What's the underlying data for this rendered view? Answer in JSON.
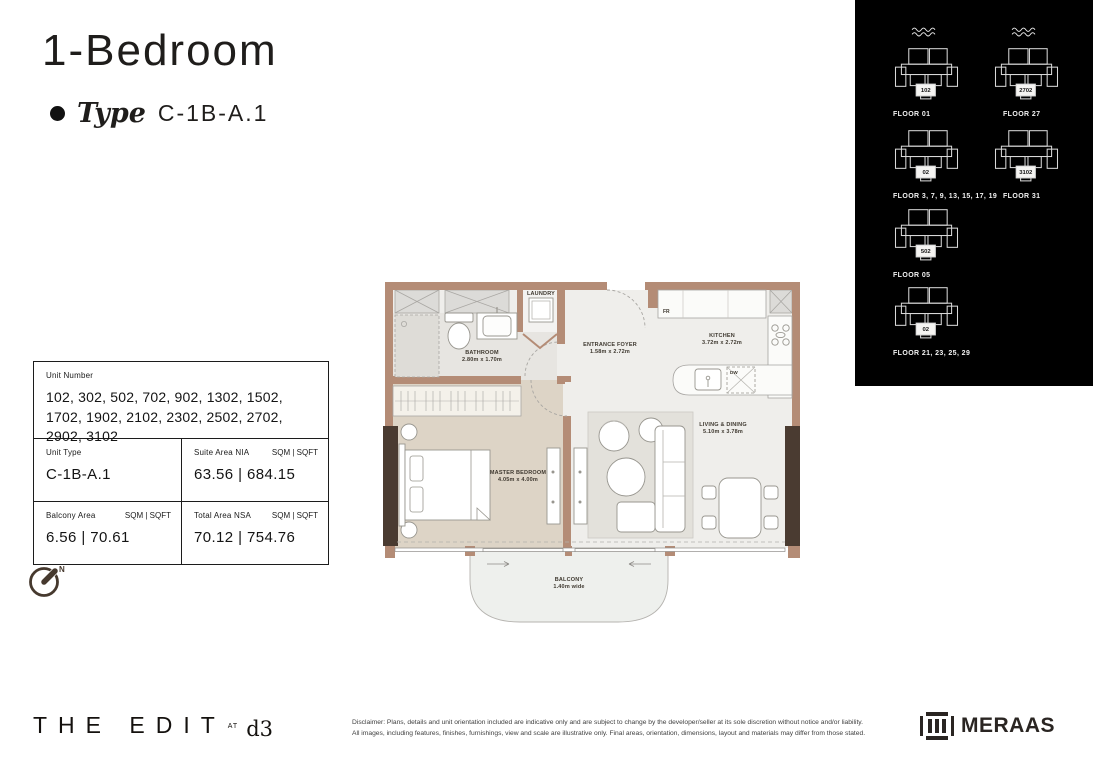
{
  "header": {
    "title": "1-Bedroom",
    "type_label": "Type",
    "type_value": "C-1B-A.1"
  },
  "unit_table": {
    "unit_number_label": "Unit Number",
    "unit_numbers": "102, 302, 502, 702, 902, 1302, 1502, 1702, 1902, 2102, 2302, 2502, 2702, 2902, 3102",
    "unit_type_label": "Unit Type",
    "unit_type_value": "C-1B-A.1",
    "suite_area_label": "Suite Area NIA",
    "suite_area_units": "SQM  |  SQFT",
    "suite_area_value": "63.56  |  684.15",
    "balcony_area_label": "Balcony Area",
    "balcony_area_units": "SQM  |  SQFT",
    "balcony_area_value": "6.56  |  70.61",
    "total_area_label": "Total Area NSA",
    "total_area_units": "SQM  |  SQFT",
    "total_area_value": "70.12  |  754.76"
  },
  "compass": {
    "north_label": "N"
  },
  "floor_plan": {
    "rooms": {
      "laundry": {
        "name": "LAUNDRY",
        "dims": ""
      },
      "bathroom": {
        "name": "BATHROOM",
        "dims": "2.80m x 1.70m"
      },
      "foyer": {
        "name": "ENTRANCE FOYER",
        "dims": "1.58m x 2.72m"
      },
      "kitchen": {
        "name": "KITCHEN",
        "dims": "3.72m x 2.72m"
      },
      "bedroom": {
        "name": "MASTER BEDROOM",
        "dims": "4.05m x 4.00m"
      },
      "living": {
        "name": "LIVING & DINING",
        "dims": "5.10m x 3.78m"
      },
      "balcony": {
        "name": "BALCONY",
        "dims": "1.40m wide"
      }
    },
    "labels": {
      "fridge": "FR",
      "dishwasher": "DW"
    }
  },
  "floor_plates": [
    {
      "floor_label": "FLOOR  01",
      "unit": "102"
    },
    {
      "floor_label": "FLOOR  27",
      "unit": "2702"
    },
    {
      "floor_label": "FLOOR  3, 7, 9, 13, 15, 17, 19",
      "unit": "02"
    },
    {
      "floor_label": "FLOOR  31",
      "unit": "3102"
    },
    {
      "floor_label": "FLOOR  05",
      "unit": "502"
    },
    {
      "floor_label": "FLOOR  21, 23, 25, 29",
      "unit": "02"
    }
  ],
  "footer": {
    "brand": "THE EDIT",
    "brand_at": "AT",
    "brand_d3": "d3",
    "disclaimer_line1": "Disclaimer: Plans, details and unit orientation included are indicative only and are subject to change by the developer/seller at its sole discretion without notice and/or liability.",
    "disclaimer_line2": "All images, including features, finishes, furnishings, view and scale are illustrative only. Final areas, orientation, dimensions, layout and materials may differ from those stated.",
    "meraas": "MERAAS"
  },
  "colors": {
    "wall": "#b48c76",
    "window_frame": "#4a3b31",
    "panel_background": "#000000",
    "bedroom_floor": "#ddd4c6",
    "bathroom_floor": "#e7e5e1",
    "living_floor": "#efeeeb",
    "text": "#1f1d1b"
  }
}
